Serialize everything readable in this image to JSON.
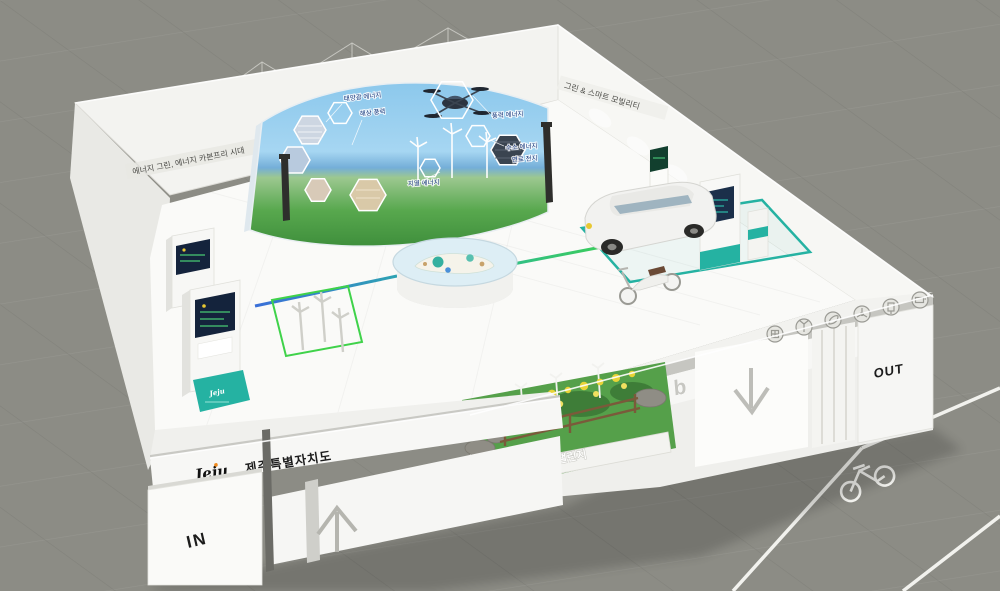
{
  "booth": {
    "banner": "smart hub",
    "entrance_label": "IN",
    "exit_label": "OUT",
    "brand": {
      "logo": "Jeju",
      "name": "제주특별자치도"
    },
    "left_wall_text": "에너지 그린, 에너지 카본프리 시대",
    "right_wall_text": "그린 & 스마트 모빌리티",
    "garden_sign": "제주 스마트시티 챌린지",
    "kiosk_base_label": "Jeju"
  },
  "screen": {
    "labels": [
      "태양광 에너지",
      "해상 풍력",
      "풍력 에너지",
      "수소 에너지",
      "연료 전지",
      "지열 에너지"
    ]
  },
  "icons": {
    "wall_row": [
      "solar-icon",
      "wind-turbine-icon",
      "leaf-icon",
      "fan-icon",
      "charger-icon",
      "battery-icon"
    ],
    "floor": [
      "bicycle-icon",
      "arrow-up-icon",
      "arrow-down-icon"
    ]
  },
  "colors": {
    "accent_teal": "#2ab5a5",
    "grass_green": "#55a04a",
    "sky_blue": "#8cc8ec",
    "floor_grey": "#8c8c85",
    "booth_white": "#f4f4f1",
    "flower_yellow": "#e8d437"
  }
}
